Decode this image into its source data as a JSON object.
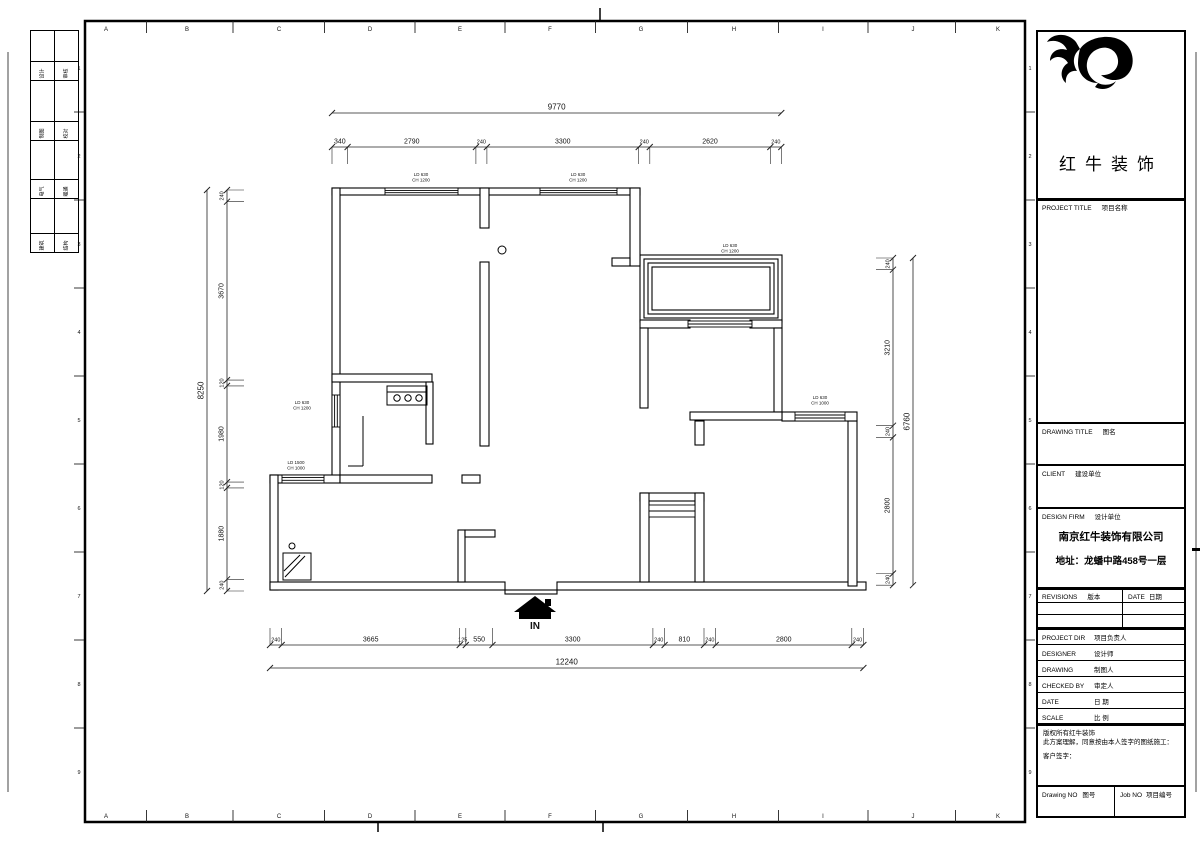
{
  "sheet": {
    "top_ruler_letters": [
      "A",
      "B",
      "C",
      "D",
      "E",
      "F",
      "G",
      "H",
      "I",
      "J",
      "K"
    ],
    "bottom_ruler_letters": [
      "A",
      "B",
      "C",
      "D",
      "E",
      "F",
      "G",
      "H",
      "I",
      "J",
      "K"
    ],
    "side_ruler_numbers": [
      "1",
      "2",
      "3",
      "4",
      "5",
      "6",
      "7",
      "8",
      "9"
    ],
    "signoff_rows": [
      [
        "设计",
        "审核"
      ],
      [
        "制图",
        "校对"
      ],
      [
        "电气",
        "暖通"
      ],
      [
        "建筑",
        "结构"
      ]
    ]
  },
  "title_block": {
    "brand": "红牛装饰",
    "sec_project": {
      "en": "PROJECT TITLE",
      "cn": "项目名称"
    },
    "sec_drawing": {
      "en": "DRAWING TITLE",
      "cn": "图名"
    },
    "sec_client": {
      "en": "CLIENT",
      "cn": "建设单位"
    },
    "sec_firm": {
      "en": "DESIGN FIRM",
      "cn": "设计单位"
    },
    "firm_name": "南京红牛装饰有限公司",
    "firm_address": "地址：龙蟠中路458号一层",
    "revisions": {
      "en": "REVISIONS",
      "cn": "版本"
    },
    "rev_date": {
      "en": "DATE",
      "cn": "日期"
    },
    "rows": [
      {
        "en": "PROJECT DIR",
        "cn": "项目负责人"
      },
      {
        "en": "DESIGNER",
        "cn": "设计师"
      },
      {
        "en": "DRAWING",
        "cn": "制图人"
      },
      {
        "en": "CHECKED BY",
        "cn": "审定人"
      },
      {
        "en": "DATE",
        "cn": "日 期"
      },
      {
        "en": "SCALE",
        "cn": "比 例"
      }
    ],
    "copyright": [
      "版权所有红牛装饰",
      "此方案理解，同意按由本人签字的图纸施工：",
      "客户签字："
    ],
    "drawing_no": {
      "en": "Drawing NO",
      "cn": "图号"
    },
    "job_no": {
      "en": "Job NO",
      "cn": "项目编号"
    }
  },
  "plan": {
    "entry_label": "IN",
    "dims": {
      "top_overall": "9770",
      "top_segments": [
        "340",
        "2790",
        "240",
        "3300",
        "240",
        "2620",
        "240"
      ],
      "bottom_segments": [
        "240",
        "3665",
        "125",
        "550",
        "3300",
        "240",
        "810",
        "240",
        "2800",
        "240"
      ],
      "bottom_overall": "12240",
      "left_overall": "8250",
      "left_segments": [
        "240",
        "3670",
        "120",
        "1980",
        "120",
        "1880",
        "240"
      ],
      "right_segments": [
        "240",
        "3210",
        "240",
        "2800",
        "240"
      ],
      "right_overall": "6760"
    },
    "window_labels": [
      {
        "lines": [
          "LD 630",
          "CH 1200"
        ]
      },
      {
        "lines": [
          "LD 630",
          "CH 1200"
        ]
      },
      {
        "lines": [
          "LD 630",
          "CH 1200"
        ]
      },
      {
        "lines": [
          "LD 630",
          "CH 1200"
        ]
      },
      {
        "lines": [
          "LD 1500",
          "CH 1000"
        ]
      },
      {
        "lines": [
          "LD 630",
          "CH 1000"
        ]
      }
    ]
  }
}
